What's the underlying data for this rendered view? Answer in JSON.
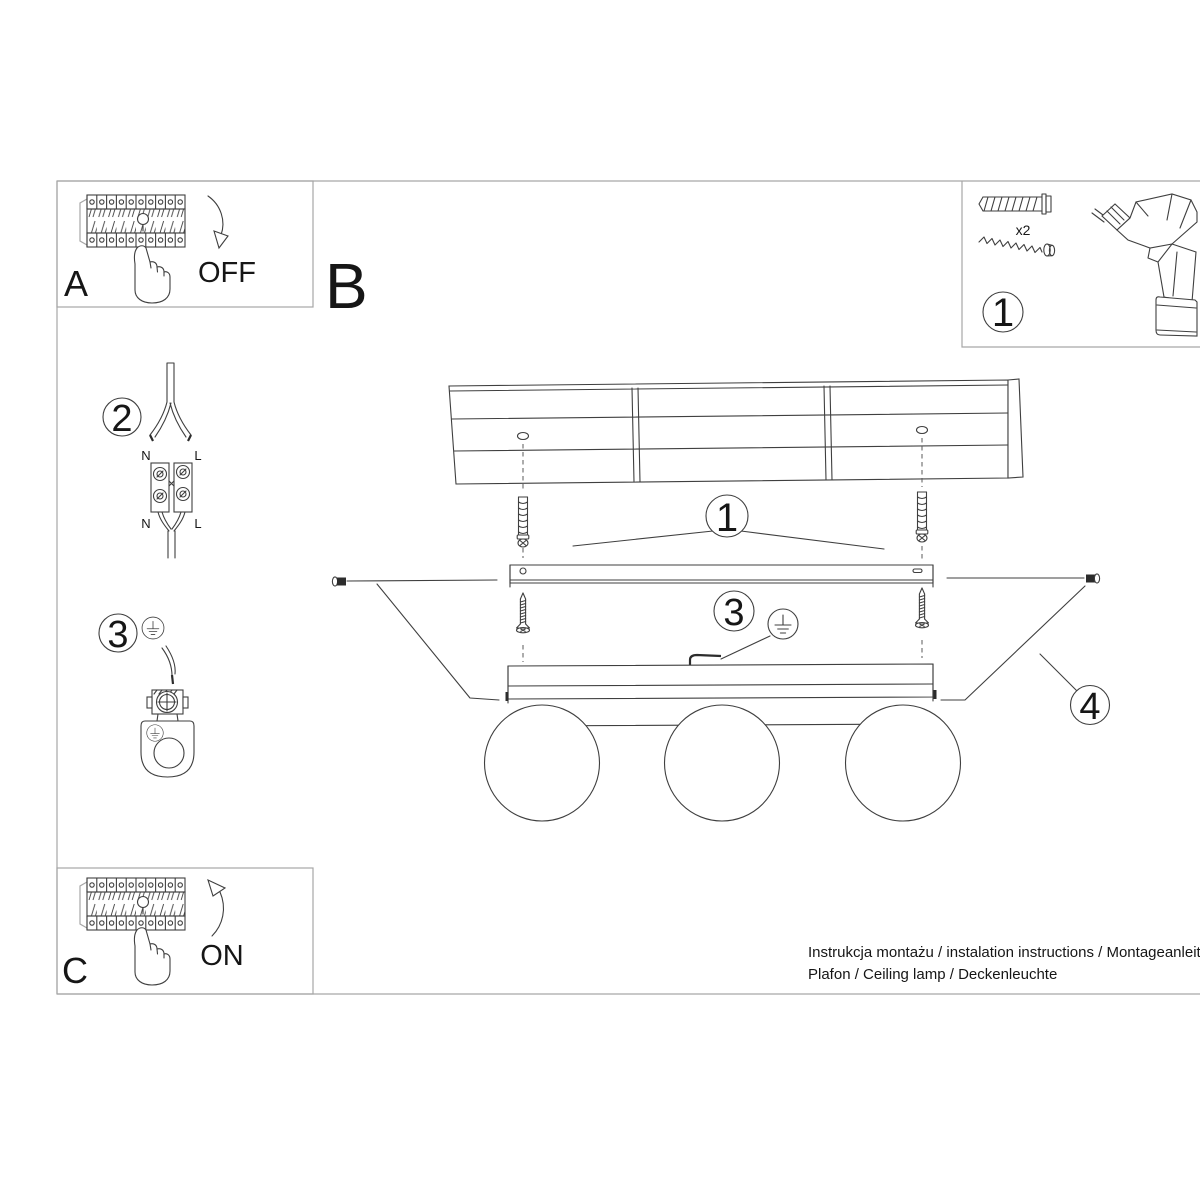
{
  "sections": {
    "a": "A",
    "b": "B",
    "c": "C",
    "off": "OFF",
    "on": "ON"
  },
  "callouts": {
    "tools": "1",
    "anchors": "1",
    "wiring": "2",
    "ground_side": "3",
    "ground_main": "3",
    "screws_side": "4"
  },
  "labels": {
    "qty": "x2",
    "n_top": "N",
    "l_top": "L",
    "n_bottom": "N",
    "l_bottom": "L"
  },
  "footer": {
    "line1": "Instrukcja montażu / instalation instructions / Montageanleitung",
    "line2": "Plafon / Ceiling lamp / Deckenleuchte"
  },
  "colors": {
    "line": "#3f3f3f",
    "frame": "#a6a6a6",
    "text": "#161616"
  }
}
